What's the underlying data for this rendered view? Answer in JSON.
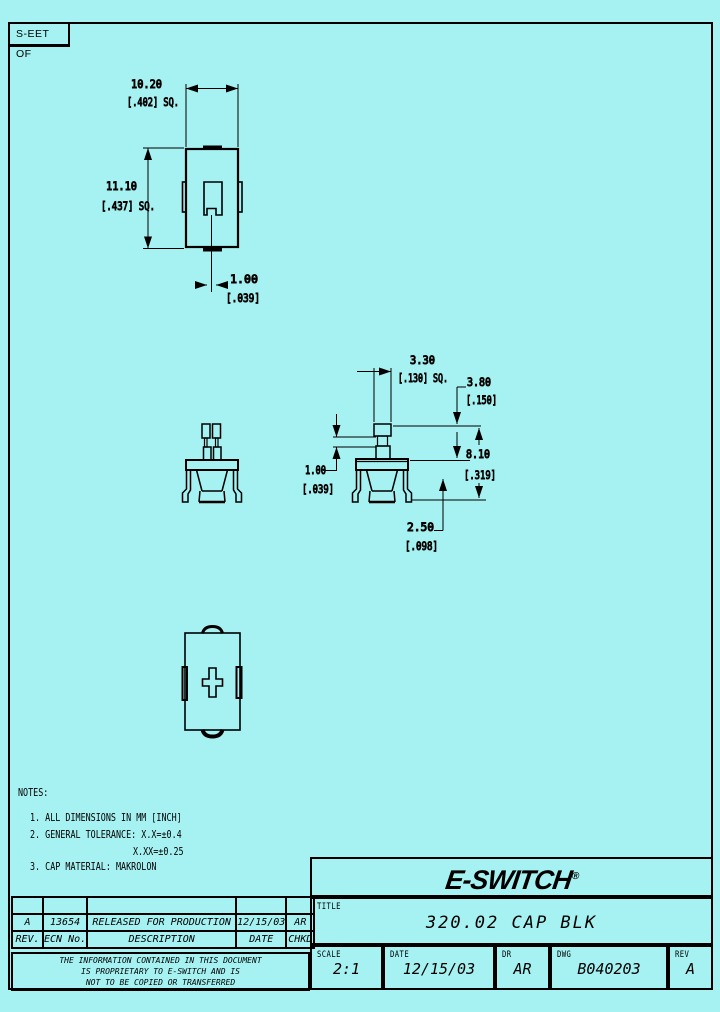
{
  "page": {
    "sheet_label": "S-EET OF"
  },
  "colors": {
    "background": "#a6f1f1",
    "ink": "#000000"
  },
  "drawing": {
    "dims": {
      "top_width_mm": "10.20",
      "top_width_in": "[.402] SQ.",
      "top_height_mm": "11.10",
      "top_height_in": "[.437] SQ.",
      "notch_mm": "1.00",
      "notch_in": "[.039]",
      "stem_sq_mm": "3.30",
      "stem_sq_in": "[.130] SQ.",
      "stem_h_mm": "3.80",
      "stem_h_in": "[.150]",
      "overall_mm": "8.10",
      "overall_in": "[.319]",
      "neck_mm": "1.00",
      "neck_in": "[.039]",
      "skirt_mm": "2.50",
      "skirt_in": "[.098]"
    }
  },
  "notes": {
    "heading": "NOTES:",
    "item1": "1. ALL DIMENSIONS IN MM [INCH]",
    "item2": "2. GENERAL TOLERANCE: X.X=±0.4",
    "item2b": "X.XX=±0.25",
    "item3": "3. CAP MATERIAL: MAKROLON"
  },
  "rev_table": {
    "row": {
      "rev": "A",
      "ecn": "13654",
      "desc": "RELEASED FOR PRODUCTION",
      "date": "12/15/03",
      "chkd": "AR"
    },
    "head": {
      "rev": "REV.",
      "ecn": "ECN No.",
      "desc": "DESCRIPTION",
      "date": "DATE",
      "chkd": "CHKD"
    },
    "proprietary1": "THE INFORMATION CONTAINED IN THIS DOCUMENT",
    "proprietary2": "IS PROPRIETARY TO E-SWITCH AND IS",
    "proprietary3": "NOT TO BE COPIED OR TRANSFERRED"
  },
  "title_block": {
    "logo": "E-SWITCH",
    "logo_reg": "®",
    "title_label": "TITLE",
    "title": "320.02 CAP BLK",
    "scale_label": "SCALE",
    "scale": "2:1",
    "date_label": "DATE",
    "date": "12/15/03",
    "dr_label": "DR",
    "dr": "AR",
    "dwg_label": "DWG",
    "dwg": "B040203",
    "rev_label": "REV",
    "rev": "A"
  }
}
